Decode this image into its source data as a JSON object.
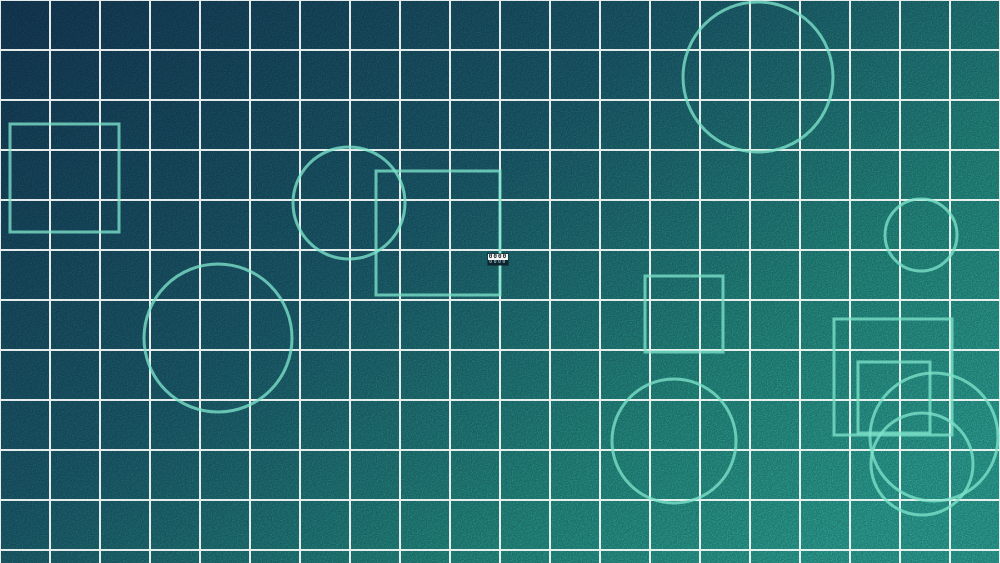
{
  "canvas": {
    "width": 1000,
    "height": 563,
    "background": {
      "gradient_stops": [
        {
          "offset": "0%",
          "color": "#163f5e"
        },
        {
          "offset": "45%",
          "color": "#1d6375"
        },
        {
          "offset": "78%",
          "color": "#27968b"
        },
        {
          "offset": "100%",
          "color": "#2fab9e"
        }
      ],
      "noise_opacity": 0.28
    },
    "grid": {
      "spacing": 50,
      "color": "#f7faf7",
      "opacity": 0.92,
      "thickness": 2
    },
    "shape_style": {
      "stroke": "#7de3cb",
      "stroke_opacity": 0.78,
      "stroke_width": 3
    },
    "shapes": [
      {
        "type": "square",
        "x": 10,
        "y": 124,
        "w": 109,
        "h": 108
      },
      {
        "type": "circle",
        "cx": 349,
        "cy": 203,
        "r": 56
      },
      {
        "type": "square",
        "x": 376,
        "y": 171,
        "w": 124,
        "h": 124
      },
      {
        "type": "circle",
        "cx": 758,
        "cy": 77,
        "r": 75
      },
      {
        "type": "circle",
        "cx": 218,
        "cy": 338,
        "r": 74
      },
      {
        "type": "circle",
        "cx": 921,
        "cy": 235,
        "r": 36
      },
      {
        "type": "square",
        "x": 645,
        "y": 276,
        "w": 78,
        "h": 76
      },
      {
        "type": "circle",
        "cx": 674,
        "cy": 441,
        "r": 62
      },
      {
        "type": "square",
        "x": 834,
        "y": 319,
        "w": 118,
        "h": 116
      },
      {
        "type": "square",
        "x": 858,
        "y": 362,
        "w": 72,
        "h": 71
      },
      {
        "type": "circle",
        "cx": 934,
        "cy": 437,
        "r": 64
      },
      {
        "type": "circle",
        "cx": 922,
        "cy": 464,
        "r": 51
      }
    ]
  },
  "badge": {
    "value": "0000",
    "x": 488,
    "y": 254,
    "width": 20
  }
}
